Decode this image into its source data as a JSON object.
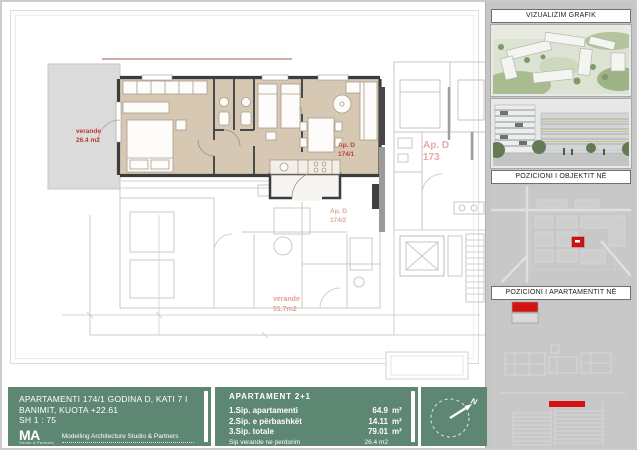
{
  "colors": {
    "green": "#5d8673",
    "marker_red": "#d61111",
    "label_red": "#bf382d",
    "faded_label_red": "#e2a09a",
    "apartment_fill_tan": "#d6c8b3",
    "sidebar_gray": "#c6c6c6"
  },
  "plan": {
    "veranda": {
      "line1": "verande",
      "line2": "26.4 m2"
    },
    "apartment": {
      "line1": "Ap. D",
      "line2": "174/1"
    },
    "neighbor": {
      "line1": "Ap. D",
      "line2": "173"
    },
    "lower_apartment": {
      "line1": "Ap. D",
      "line2": "174/2"
    },
    "lower_veranda": {
      "line1": "verande",
      "line2": "51.7m2"
    }
  },
  "sidebar": {
    "section1_title": "VIZUALIZIM GRAFIK",
    "section2_title": "POZICIONI I OBJEKTIT NË MASTERPLAN",
    "section3_title": "POZICIONI I APARTAMENTIT NË OBJEKT"
  },
  "titleblock": {
    "line1": "APARTAMENTI 174/1 GODINA D, KATI 7 I",
    "line2": "BANIMIT, KUOTA +22.61",
    "scale": "SH 1 : 75",
    "logo": "MA",
    "logo_sub": "Studio & Partners",
    "studio_name": "Modelling Architecture Studio & Partners"
  },
  "area_table": {
    "title": "APARTAMENT 2+1",
    "rows": [
      {
        "label": "1.Sip. apartamenti",
        "value": "64.9",
        "unit": "m²"
      },
      {
        "label": "2.Sip. e përbashkët",
        "value": "14.11",
        "unit": "m²"
      },
      {
        "label": "3.Sip. totale",
        "value": "79.01",
        "unit": "m²"
      },
      {
        "label": "Sip verande ne perdorim",
        "value": "26.4 m2",
        "unit": ""
      }
    ]
  },
  "compass": {
    "north_label": "N"
  }
}
